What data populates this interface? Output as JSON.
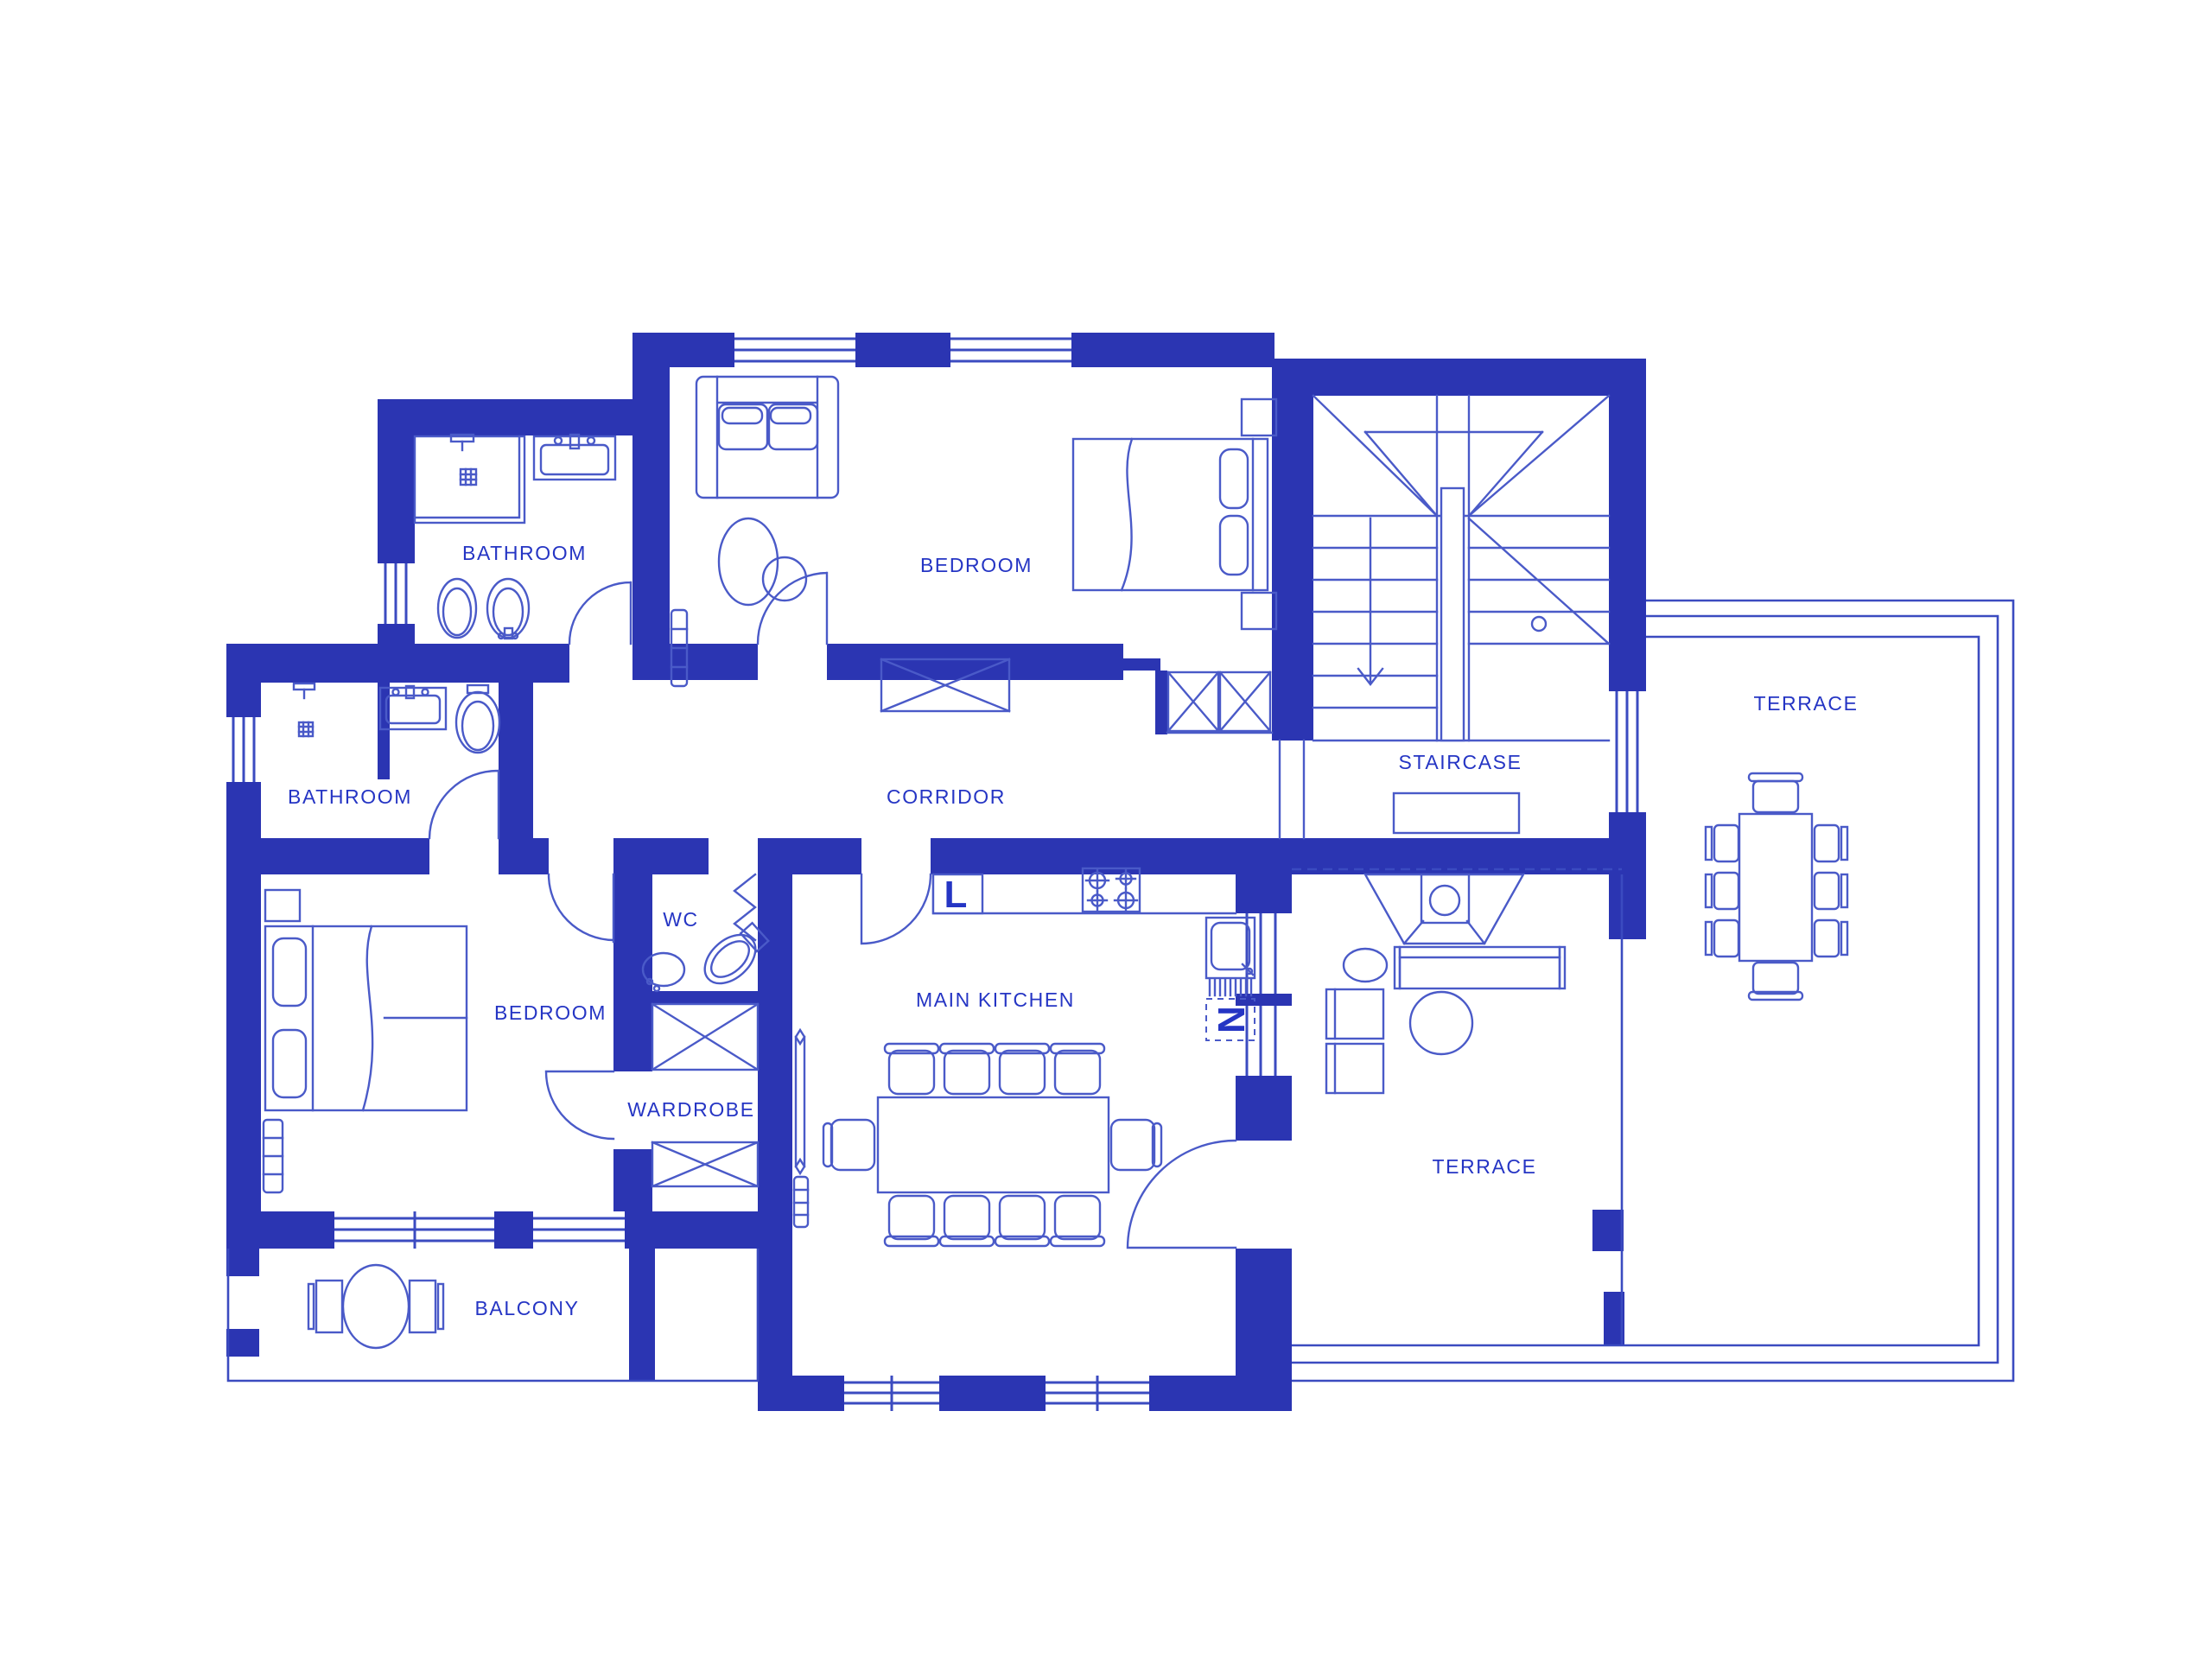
{
  "colors": {
    "wall": "#2b35b2",
    "line": "#4a5ac8",
    "thin": "#3b4bc0",
    "text": "#2535c4",
    "bg": "#ffffff"
  },
  "rooms": [
    {
      "id": "bathroom-top",
      "label": "BATHROOM"
    },
    {
      "id": "bedroom-top",
      "label": "BEDROOM"
    },
    {
      "id": "staircase",
      "label": "STAIRCASE"
    },
    {
      "id": "terrace-right",
      "label": "TERRACE"
    },
    {
      "id": "bathroom-left",
      "label": "BATHROOM"
    },
    {
      "id": "corridor",
      "label": "CORRIDOR"
    },
    {
      "id": "wc",
      "label": "WC"
    },
    {
      "id": "bedroom-lower",
      "label": "BEDROOM"
    },
    {
      "id": "wardrobe",
      "label": "WARDROBE"
    },
    {
      "id": "main-kitchen",
      "label": "MAIN KITCHEN"
    },
    {
      "id": "terrace-bottom",
      "label": "TERRACE"
    },
    {
      "id": "balcony",
      "label": "BALCONY"
    }
  ],
  "appliance_marks": {
    "kitchen_counter_left": "L",
    "kitchen_sink": "N"
  }
}
